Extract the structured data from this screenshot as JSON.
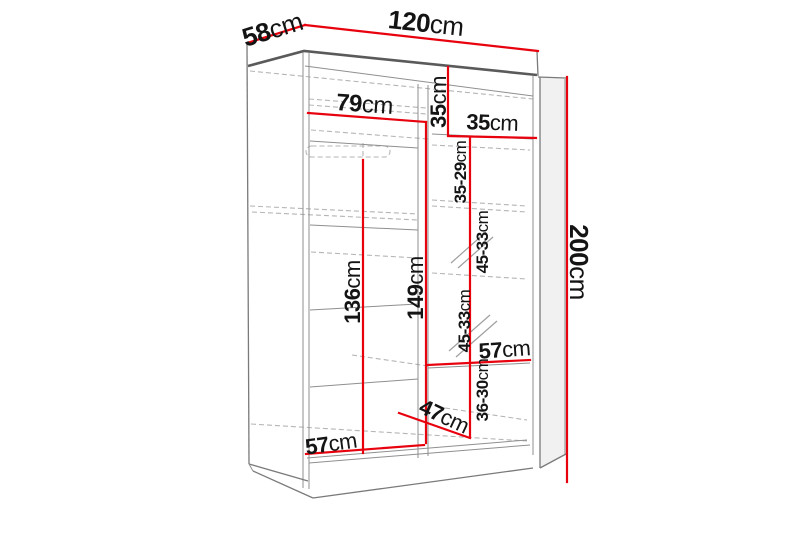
{
  "diagram": {
    "kind": "wardrobe-interior-dimension-diagram",
    "colors": {
      "dimension_line": "#e8020e",
      "structure_line": "#7a7a7a",
      "hidden_line": "#b5b5b5",
      "text": "#141414",
      "background": "#ffffff"
    },
    "labels": {
      "depth": {
        "value": "58",
        "unit": "cm"
      },
      "width": {
        "value": "120",
        "unit": "cm"
      },
      "height": {
        "value": "200",
        "unit": "cm"
      },
      "left_section_width": {
        "value": "79",
        "unit": "cm"
      },
      "top_shelf_height": {
        "value": "35",
        "unit": "cm"
      },
      "top_shelf_width": {
        "value": "35",
        "unit": "cm"
      },
      "shelf_zone_1": {
        "value": "35-29",
        "unit": "cm"
      },
      "shelf_zone_2": {
        "value": "45-33",
        "unit": "cm"
      },
      "shelf_zone_3": {
        "value": "45-33",
        "unit": "cm"
      },
      "hanging_height": {
        "value": "136",
        "unit": "cm"
      },
      "right_inner_height": {
        "value": "149",
        "unit": "cm"
      },
      "left_bottom_width": {
        "value": "57",
        "unit": "cm"
      },
      "right_shelf_width": {
        "value": "57",
        "unit": "cm"
      },
      "bottom_zone_height": {
        "value": "36-30",
        "unit": "cm"
      },
      "bottom_depth": {
        "value": "47",
        "unit": "cm"
      }
    }
  }
}
